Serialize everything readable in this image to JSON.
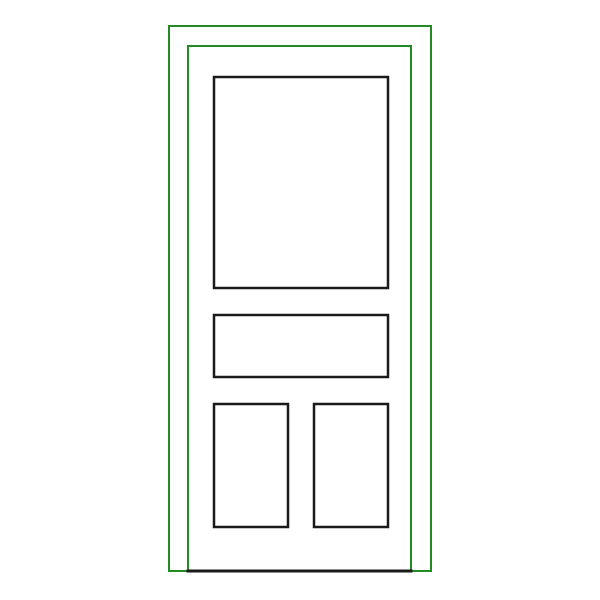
{
  "canvas": {
    "width": "600",
    "height": "600",
    "background_color": "#ffffff"
  },
  "colors": {
    "frame_green": "#228B22",
    "panel_black": "#1a1a1a"
  },
  "door": {
    "frame_outer": {
      "x": "169",
      "y": "26",
      "width": "262",
      "height": "545",
      "stroke": "#228B22",
      "stroke_width": "2"
    },
    "frame_inner": {
      "x": "188",
      "y": "46",
      "width": "223",
      "height": "525",
      "stroke": "#228B22",
      "stroke_width": "2"
    },
    "threshold_line": {
      "x1": "186.5",
      "y1": "571",
      "x2": "412.5",
      "y2": "571",
      "stroke": "#1a1a1a",
      "stroke_width": "3"
    },
    "panel_top": {
      "x": "214",
      "y": "77",
      "width": "174",
      "height": "211",
      "stroke": "#1a1a1a",
      "stroke_width": "2.5"
    },
    "panel_middle": {
      "x": "214",
      "y": "315",
      "width": "174",
      "height": "62",
      "stroke": "#1a1a1a",
      "stroke_width": "2.5"
    },
    "panel_bottom_left": {
      "x": "214",
      "y": "404",
      "width": "74",
      "height": "123",
      "stroke": "#1a1a1a",
      "stroke_width": "2.5"
    },
    "panel_bottom_right": {
      "x": "314",
      "y": "404",
      "width": "74",
      "height": "123",
      "stroke": "#1a1a1a",
      "stroke_width": "2.5"
    }
  }
}
